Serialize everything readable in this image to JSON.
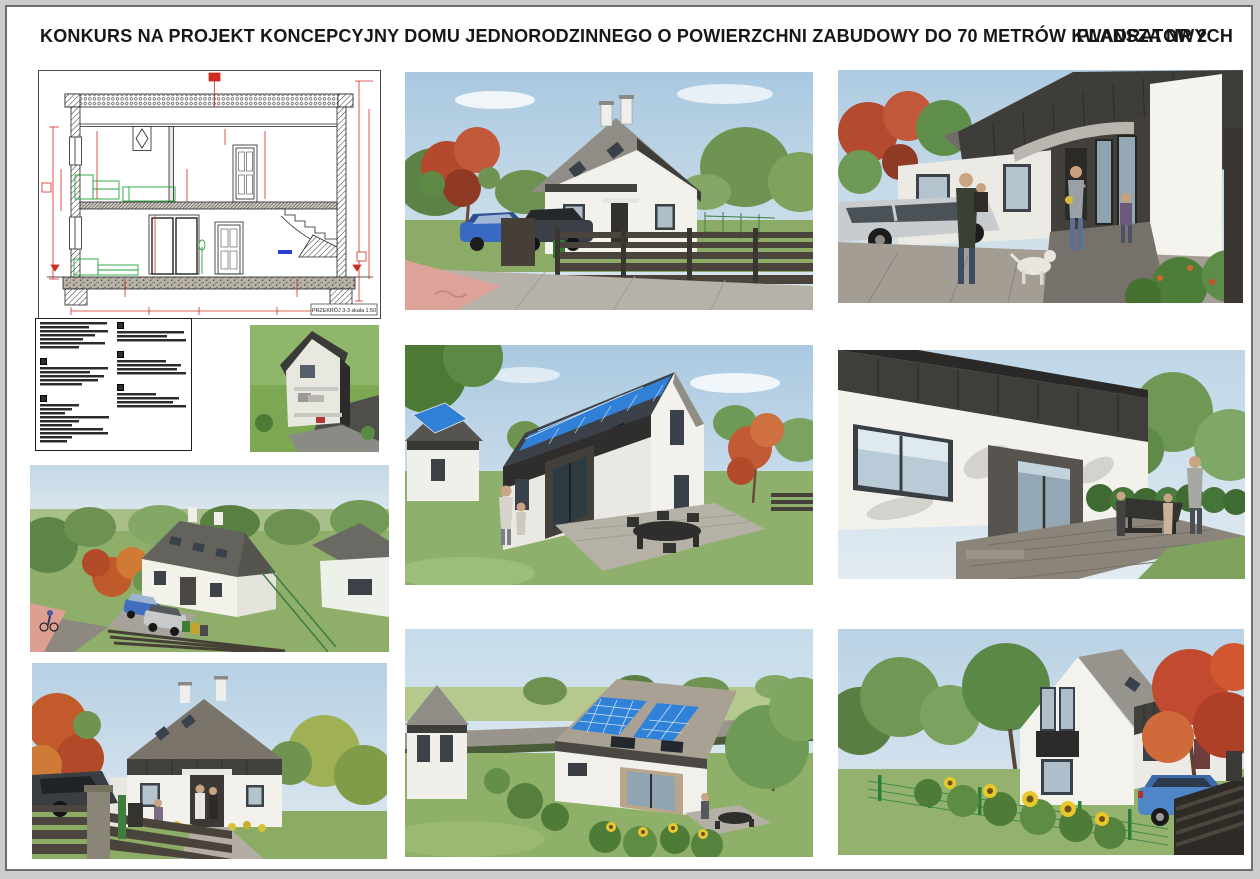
{
  "header": {
    "title": "KONKURS NA PROJEKT KONCEPCYJNY DOMU JEDNORODZINNEGO O POWIERZCHNI ZABUDOWY DO 70 METRÓW KWADRATOWYCH",
    "board_label": "PLANSZA NR 2"
  },
  "section_drawing": {
    "caption": "PRZEKRÓJ 3-3 skala 1:50"
  },
  "legend": {
    "columns": [
      {
        "blocks": [
          {
            "marker": false,
            "lines": [
              95,
              70,
              97,
              78,
              62,
              93,
              55
            ]
          },
          {
            "marker": true,
            "lines": [
              97,
              72,
              92,
              83,
              60
            ]
          },
          {
            "marker": true,
            "lines": [
              55,
              45,
              35,
              98,
              55,
              45,
              90,
              97,
              45,
              38
            ]
          }
        ]
      },
      {
        "blocks": [
          {
            "marker": true,
            "lines": [
              95,
              72,
              99
            ]
          },
          {
            "marker": true,
            "lines": [
              70,
              92,
              85,
              99
            ]
          },
          {
            "marker": true,
            "lines": [
              55,
              88,
              80,
              99
            ]
          }
        ]
      }
    ]
  },
  "palette": {
    "wall_white": "#f2f1ec",
    "dark_cladding": "#3f3d3a",
    "roof_gray": "#8f8d86",
    "pv_blue": "#2f80d6",
    "grass_green": "#8cab67",
    "sky_blue": "#bdd5e7",
    "fence_dark": "#47413a",
    "bike_path_pink": "#dda398",
    "autumn_red": "#b54a2e",
    "dimension_red": "#cf2b20",
    "furniture_green": "#28a23c",
    "glass_blue": "#9db2bf"
  }
}
